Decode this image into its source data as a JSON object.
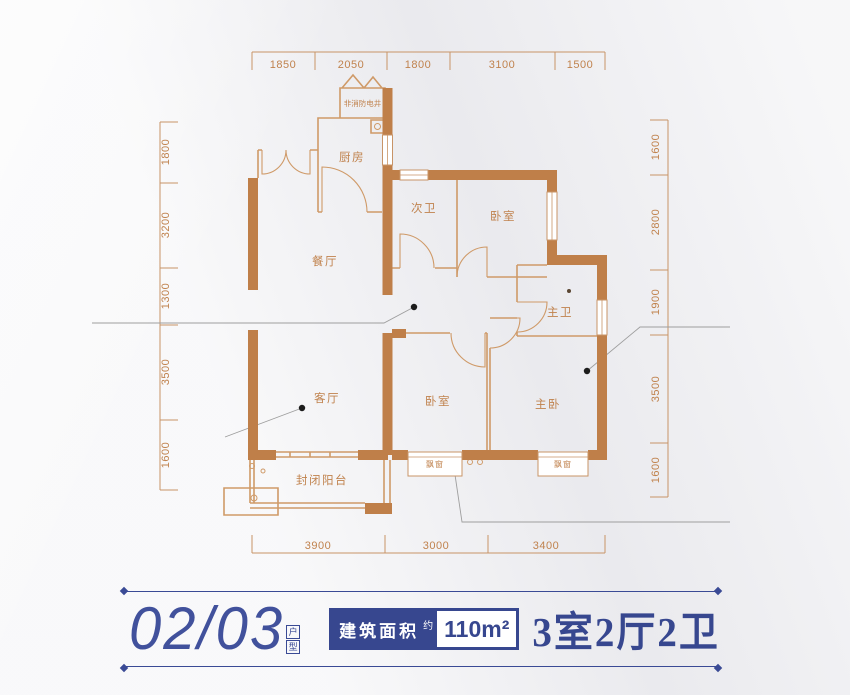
{
  "colors": {
    "wall": "#bf7f49",
    "thin_line": "#cf9a68",
    "dim_text": "#c0824d",
    "accent_blue": "#37478f",
    "background": "#efeff2"
  },
  "plan": {
    "rooms": {
      "kitchen": "厨房",
      "shaft": "非消防电井",
      "bath2": "次卫",
      "bedroom_top": "卧室",
      "dining": "餐厅",
      "master_bath": "主卫",
      "living": "客厅",
      "bedroom_bottom": "卧室",
      "master_bedroom": "主卧",
      "balcony": "封闭阳台",
      "bay_window_left": "飘窗",
      "bay_window_right": "飘窗"
    },
    "dims": {
      "top": [
        "1850",
        "2050",
        "1800",
        "3100",
        "1500"
      ],
      "left": [
        "1800",
        "3200",
        "1300",
        "3500",
        "1600"
      ],
      "right": [
        "1600",
        "2800",
        "1900",
        "3500",
        "1600"
      ],
      "bottom": [
        "3900",
        "3000",
        "3400"
      ]
    }
  },
  "banner": {
    "unit_number": "02/03",
    "seal_top": "户",
    "seal_bottom": "型",
    "area_label": "建筑面积",
    "area_approx": "约",
    "area_value": "110m²",
    "layout": "3室2厅2卫"
  }
}
